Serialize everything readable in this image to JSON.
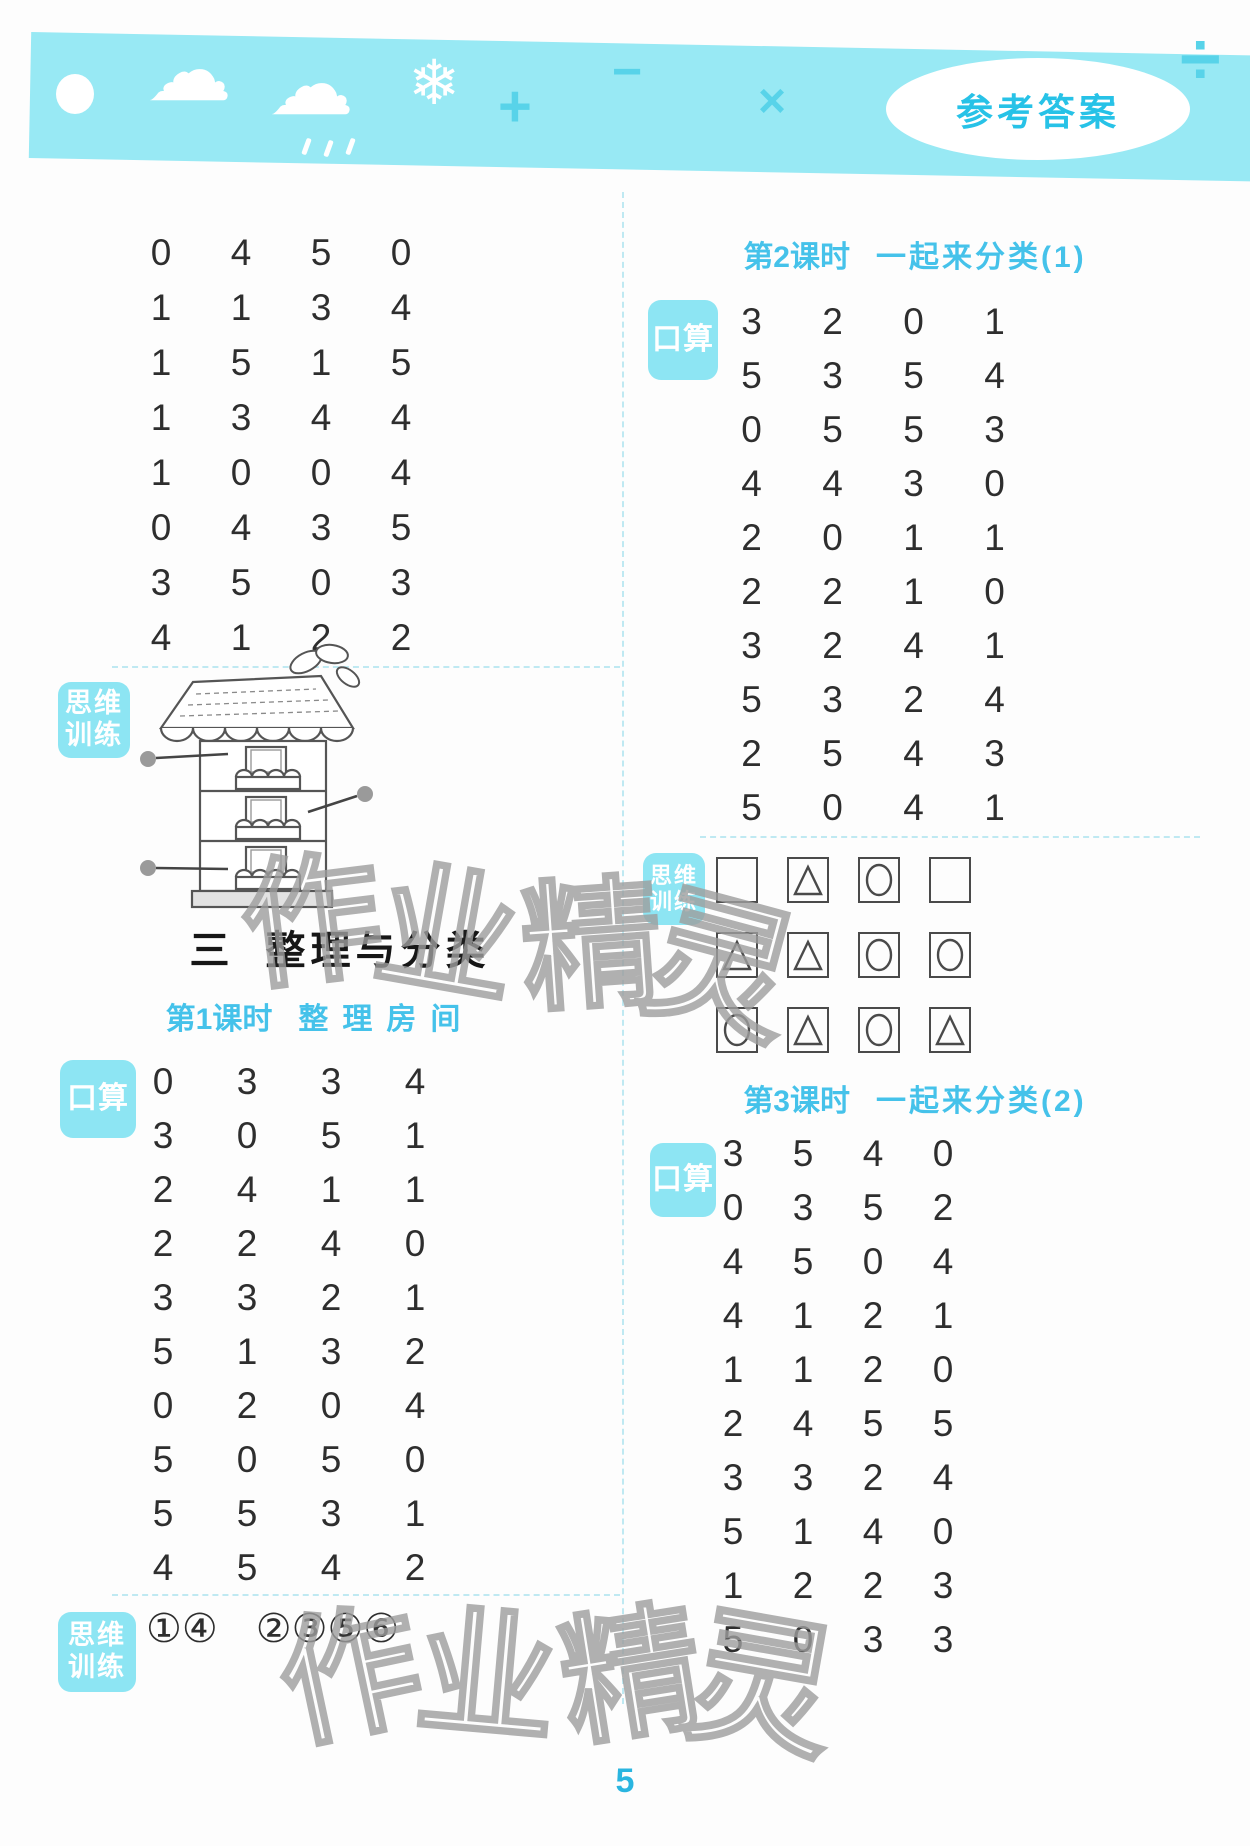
{
  "header": {
    "badge": "参考答案",
    "icons": [
      "sun-icon",
      "cloud-icon",
      "rain-cloud-icon",
      "snowflake-icon",
      "plus-icon",
      "minus-icon",
      "multiply-icon",
      "divide-icon"
    ],
    "symbols": {
      "cloud": "☁",
      "snowflake": "❄",
      "plus": "+",
      "minus": "−",
      "multiply": "×",
      "divide": "÷"
    },
    "colors": {
      "band": "#98e9f4",
      "symbol": "#58d3e9",
      "badge_text": "#27c2e7"
    }
  },
  "left": {
    "carryover_grid": {
      "rows": [
        [
          "0",
          "4",
          "5",
          "0"
        ],
        [
          "1",
          "1",
          "3",
          "4"
        ],
        [
          "1",
          "5",
          "1",
          "5"
        ],
        [
          "1",
          "3",
          "4",
          "4"
        ],
        [
          "1",
          "0",
          "0",
          "4"
        ],
        [
          "0",
          "4",
          "3",
          "5"
        ],
        [
          "3",
          "5",
          "0",
          "3"
        ],
        [
          "4",
          "1",
          "2",
          "2"
        ]
      ]
    },
    "thinking_label": {
      "line1": "思维",
      "line2": "训练"
    },
    "section": {
      "number": "三",
      "title": "整理与分类"
    },
    "lesson1": {
      "prefix": "第1课时",
      "title": "整理房间",
      "oral_label": "口算",
      "grid": {
        "rows": [
          [
            "0",
            "3",
            "3",
            "4"
          ],
          [
            "3",
            "0",
            "5",
            "1"
          ],
          [
            "2",
            "4",
            "1",
            "1"
          ],
          [
            "2",
            "2",
            "4",
            "0"
          ],
          [
            "3",
            "3",
            "2",
            "1"
          ],
          [
            "5",
            "1",
            "3",
            "2"
          ],
          [
            "0",
            "2",
            "0",
            "4"
          ],
          [
            "5",
            "0",
            "5",
            "0"
          ],
          [
            "5",
            "5",
            "3",
            "1"
          ],
          [
            "4",
            "5",
            "4",
            "2"
          ]
        ]
      },
      "thinking_answers": {
        "group1": "①④",
        "group2": "②③⑤⑥"
      }
    }
  },
  "right": {
    "lesson2": {
      "prefix": "第2课时",
      "title": "一起来分类(1)",
      "oral_label": "口算",
      "grid": {
        "rows": [
          [
            "3",
            "2",
            "0",
            "1"
          ],
          [
            "5",
            "3",
            "5",
            "4"
          ],
          [
            "0",
            "5",
            "5",
            "3"
          ],
          [
            "4",
            "4",
            "3",
            "0"
          ],
          [
            "2",
            "0",
            "1",
            "1"
          ],
          [
            "2",
            "2",
            "1",
            "0"
          ],
          [
            "3",
            "2",
            "4",
            "1"
          ],
          [
            "5",
            "3",
            "2",
            "4"
          ],
          [
            "2",
            "5",
            "4",
            "3"
          ],
          [
            "5",
            "0",
            "4",
            "1"
          ]
        ]
      },
      "thinking_shapes": {
        "rows": [
          [
            "square",
            "triangle",
            "circle",
            "square"
          ],
          [
            "triangle",
            "triangle",
            "circle",
            "circle"
          ],
          [
            "circle",
            "triangle",
            "circle",
            "triangle"
          ]
        ]
      }
    },
    "lesson3": {
      "prefix": "第3课时",
      "title": "一起来分类(2)",
      "oral_label": "口算",
      "grid": {
        "rows": [
          [
            "3",
            "5",
            "4",
            "0"
          ],
          [
            "0",
            "3",
            "5",
            "2"
          ],
          [
            "4",
            "5",
            "0",
            "4"
          ],
          [
            "4",
            "1",
            "2",
            "1"
          ],
          [
            "1",
            "1",
            "2",
            "0"
          ],
          [
            "2",
            "4",
            "5",
            "5"
          ],
          [
            "3",
            "3",
            "2",
            "4"
          ],
          [
            "5",
            "1",
            "4",
            "0"
          ],
          [
            "1",
            "2",
            "2",
            "3"
          ],
          [
            "5",
            "0",
            "3",
            "3"
          ]
        ]
      }
    }
  },
  "watermark": {
    "text": "作业精灵"
  },
  "page_number": "5"
}
